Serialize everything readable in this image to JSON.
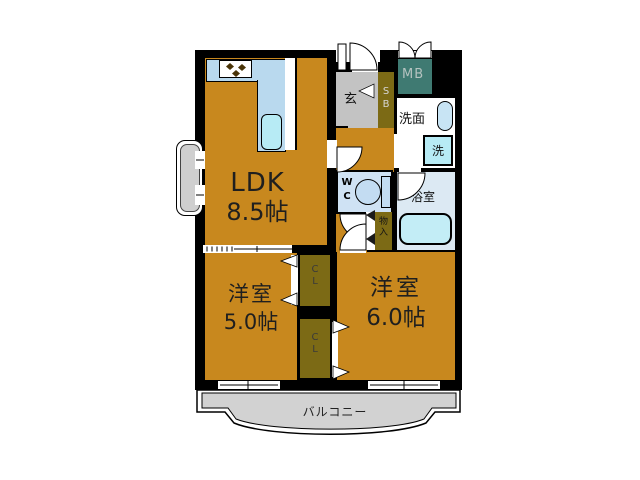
{
  "colors": {
    "wall": "#000000",
    "room": "#c8881e",
    "closet": "#7c6a15",
    "meter_box": "#3f7a72",
    "entrance": "#c3c3c3",
    "counter": "#b9d9ee",
    "sink": "#b7ebf5",
    "wc": "#cfe2f4",
    "bath": "#dce9f3",
    "tub": "#c3edf6",
    "balcony": "#d2d2d2",
    "washroom": "#ffffff"
  },
  "rooms": {
    "ldk": {
      "name": "LDK",
      "size": "8.5帖"
    },
    "bedroom_west": {
      "name": "洋室",
      "size": "5.0帖"
    },
    "bedroom_east": {
      "name": "洋室",
      "size": "6.0帖"
    },
    "entrance": {
      "label": "玄"
    },
    "shoe_box": {
      "chars": [
        "S",
        "B"
      ]
    },
    "meter_box": {
      "label": "MB"
    },
    "washroom": {
      "label": "洗面"
    },
    "washing_machine": {
      "label": "洗"
    },
    "toilet": {
      "chars": [
        "W",
        "C"
      ]
    },
    "bathroom": {
      "label": "浴室"
    },
    "storage": {
      "chars": [
        "物",
        "入"
      ]
    },
    "closet_upper": {
      "chars": [
        "C",
        "L"
      ]
    },
    "closet_lower": {
      "chars": [
        "C",
        "L"
      ]
    },
    "balcony": {
      "label": "バルコニー"
    }
  }
}
